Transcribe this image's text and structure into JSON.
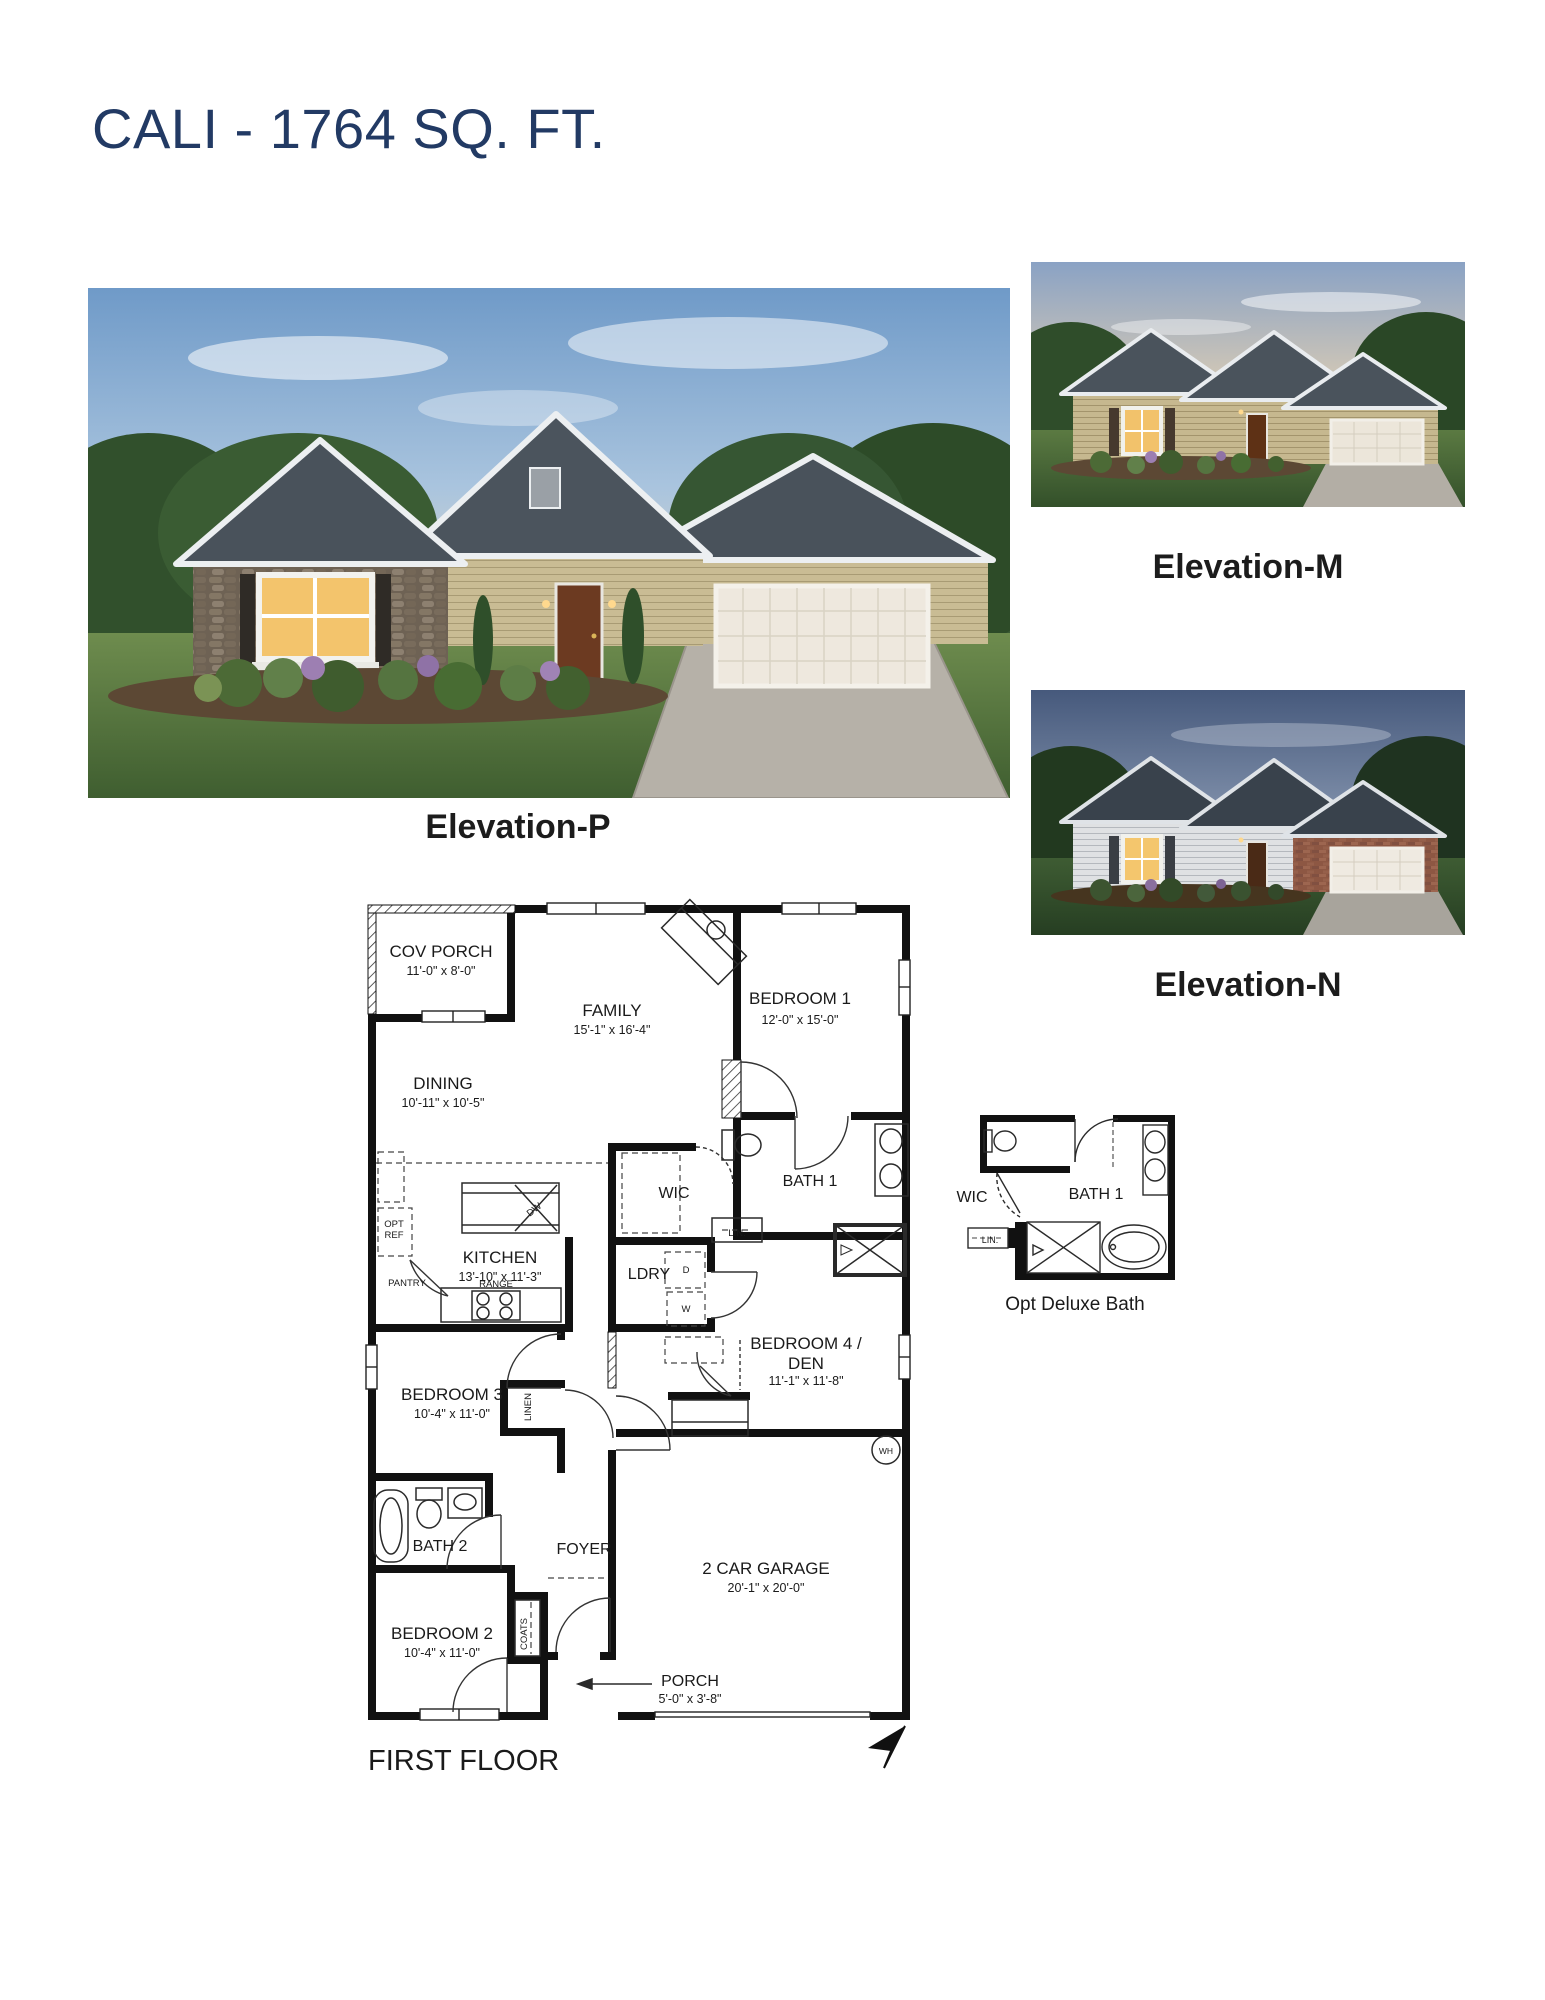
{
  "page_title": "CALI - 1764 SQ. FT.",
  "elevations": {
    "p_caption": "Elevation-P",
    "m_caption": "Elevation-M",
    "n_caption": "Elevation-N"
  },
  "floor_plan": {
    "footer_label": "FIRST FLOOR",
    "rooms": {
      "cov_porch_name": "COV PORCH",
      "cov_porch_dims": "11'-0\" x 8'-0\"",
      "family_name": "FAMILY",
      "family_dims": "15'-1\" x 16'-4\"",
      "bedroom1_name": "BEDROOM 1",
      "bedroom1_dims": "12'-0\" x 15'-0\"",
      "dining_name": "DINING",
      "dining_dims": "10'-11\" x 10'-5\"",
      "kitchen_name": "KITCHEN",
      "kitchen_dims": "13'-10\" x 11'-3\"",
      "bedroom4_name_line1": "BEDROOM 4 /",
      "bedroom4_name_line2": "DEN",
      "bedroom4_dims": "11'-1\" x 11'-8\"",
      "bedroom3_name": "BEDROOM 3",
      "bedroom3_dims": "10'-4\" x 11'-0\"",
      "bedroom2_name": "BEDROOM 2",
      "bedroom2_dims": "10'-4\" x 11'-0\"",
      "bath1": "BATH 1",
      "bath2": "BATH 2",
      "wic": "WIC",
      "ldry": "LDRY",
      "foyer": "FOYER",
      "garage_name": "2 CAR GARAGE",
      "garage_dims": "20'-1\" x 20'-0\"",
      "porch_name": "PORCH",
      "porch_dims": "5'-0\" x 3'-8\""
    },
    "small_labels": {
      "pantry": "PANTRY",
      "range": "RANGE",
      "opt_ref_line1": "OPT",
      "opt_ref_line2": "REF",
      "dw": "DW",
      "dryer": "D",
      "washer": "W",
      "lin": "LIN.",
      "linen": "LINEN",
      "coats": "COATS",
      "water_heater": "WH"
    },
    "inset": {
      "wic": "WIC",
      "bath1": "BATH 1",
      "lin": "LIN.",
      "caption": "Opt Deluxe Bath"
    }
  },
  "colors": {
    "title": "#223a64",
    "caption_text": "#1c1c1c",
    "plan_wall": "#111111",
    "plan_text": "#1a1a1a"
  }
}
